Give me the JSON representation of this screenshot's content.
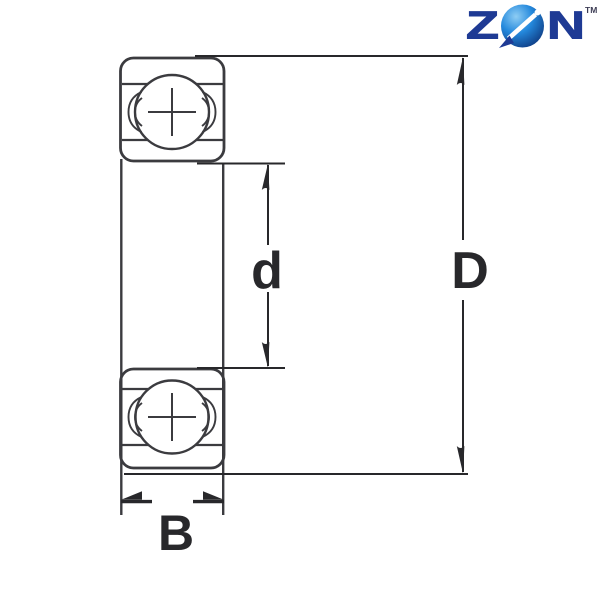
{
  "brand": {
    "name": "ZEN",
    "letter_z": "Z",
    "letter_n": "N",
    "trademark": "TM",
    "navy": "#1e3a94",
    "sphere_highlight": "#8ecdf4",
    "sphere_mid": "#2489dd",
    "sphere_dark": "#0c3278"
  },
  "diagram": {
    "type": "deep-groove ball bearing cross-section",
    "line_color": "#3b3b3f",
    "dim_color": "#28282b",
    "dimension_labels": {
      "bore_diameter": "d",
      "outer_diameter": "D",
      "width": "B"
    }
  }
}
